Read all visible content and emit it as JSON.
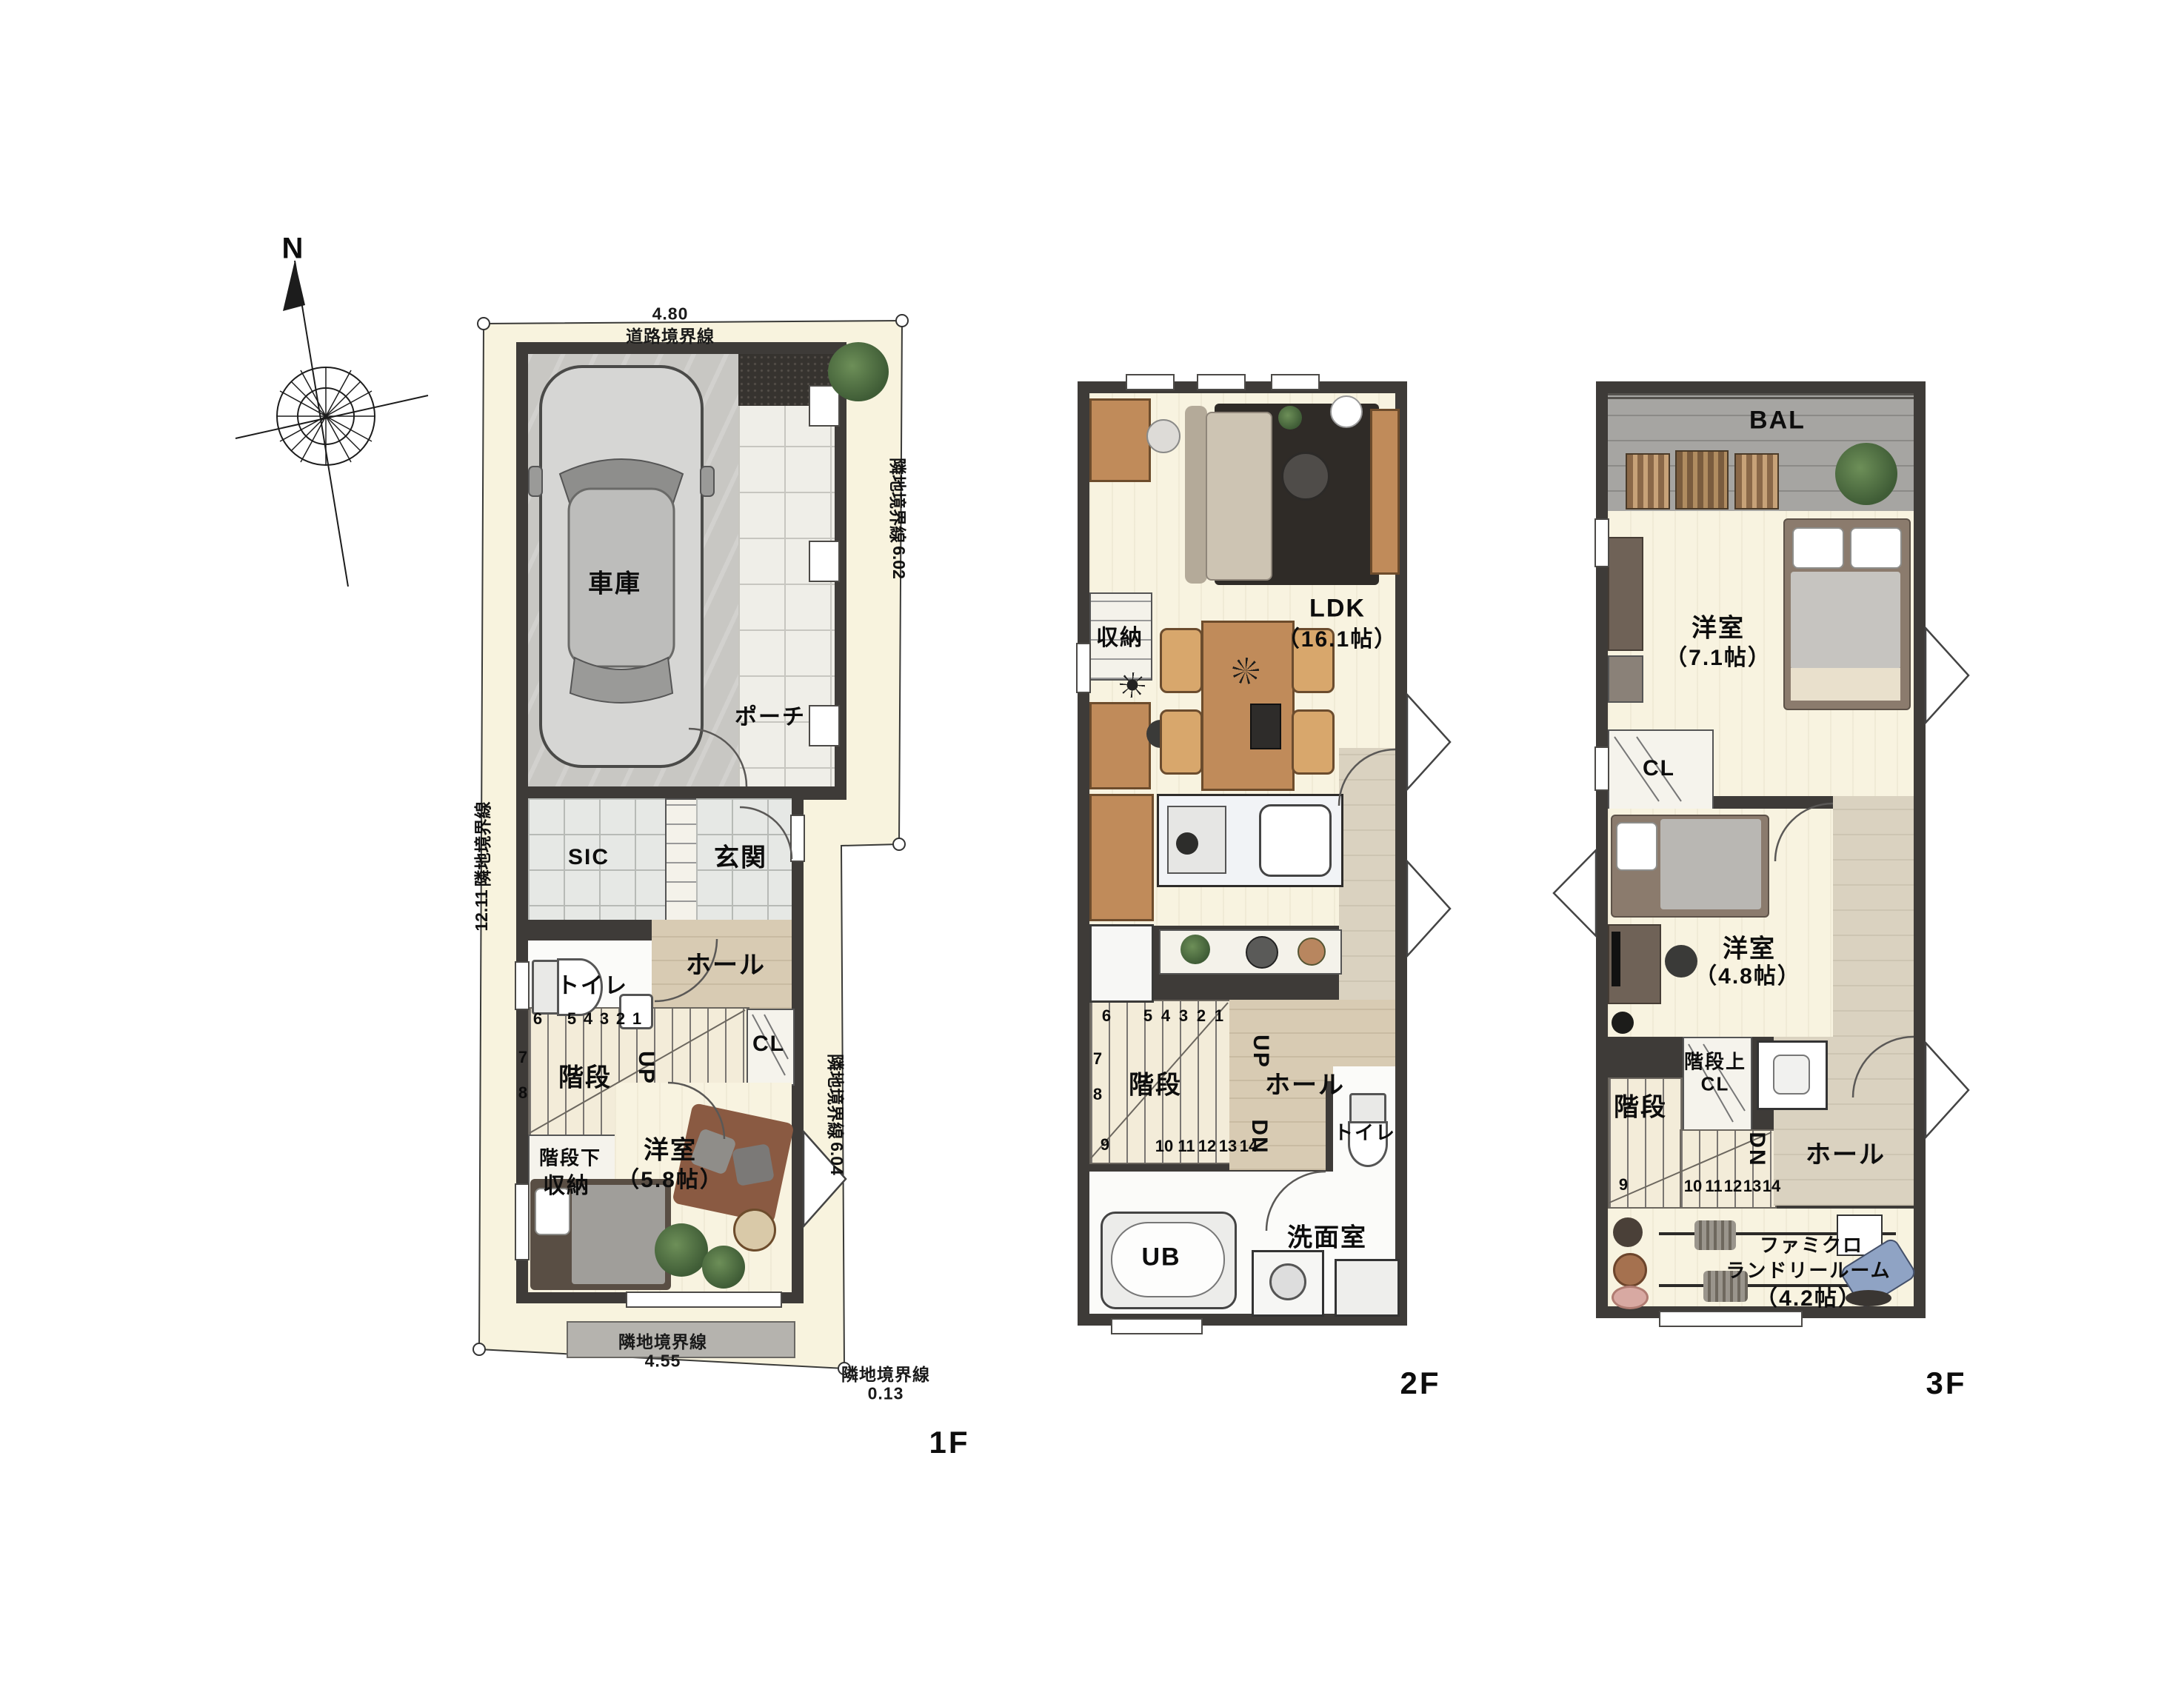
{
  "compass": {
    "north": "N"
  },
  "site": {
    "road_line": "道路境界線",
    "road_dim": "4.80",
    "left_line": "隣地境界線",
    "left_dim": "12.11",
    "right_upper_line": "隣地境界線",
    "right_upper_dim": "6.02",
    "right_lower_line": "隣地境界線",
    "right_lower_dim": "6.04",
    "bottom_line": "隣地境界線",
    "bottom_dim": "4.55",
    "bottom_right_line": "隣地境界線",
    "bottom_right_dim": "0.13"
  },
  "f1": {
    "floor": "1F",
    "garage": "車庫",
    "porch": "ポーチ",
    "sic": "SIC",
    "entrance": "玄関",
    "toilet": "トイレ",
    "hall": "ホール",
    "stairs": "階段",
    "cl": "CL",
    "understair1": "階段下",
    "understair2": "収納",
    "bedroom": "洋室",
    "bedroom_size": "（5.8帖）",
    "up": "UP",
    "steps": [
      "6",
      "5",
      "4",
      "3",
      "2",
      "1"
    ],
    "step7": "7",
    "step8": "8"
  },
  "f2": {
    "floor": "2F",
    "storage": "収納",
    "ldk": "LDK",
    "ldk_size": "（16.1帖）",
    "stairs": "階段",
    "hall": "ホール",
    "toilet": "トイレ",
    "bath": "UB",
    "wash": "洗面室",
    "up": "UP",
    "dn": "DN",
    "steps": [
      "6",
      "5",
      "4",
      "3",
      "2",
      "1"
    ],
    "step7": "7",
    "step8": "8",
    "step9": "9",
    "steps2": [
      "10",
      "11",
      "12",
      "13",
      "14"
    ]
  },
  "f3": {
    "floor": "3F",
    "bal": "BAL",
    "bedroom1": "洋室",
    "bedroom1_size": "（7.1帖）",
    "cl": "CL",
    "bedroom2": "洋室",
    "bedroom2_size": "（4.8帖）",
    "stair_cl1": "階段上",
    "stair_cl2": "CL",
    "stairs": "階段",
    "hall": "ホール",
    "famiclo1": "ファミクロ",
    "famiclo2": "ランドリールーム",
    "famiclo3": "（4.2帖）",
    "dn": "DN",
    "step9": "9",
    "steps2": [
      "10",
      "11",
      "12",
      "13",
      "14"
    ]
  },
  "colors": {
    "wall": "#3e3b38",
    "site_fill": "#f8f3de",
    "room_floor": "#f8f3e0",
    "wood_floor": "#d8cbb3",
    "tile": "#e6e8e5",
    "concrete": "#c8c7c3",
    "deck": "#a6a5a2",
    "rug_dark": "#2f2b27",
    "rug_brown": "#8a5a42",
    "furniture_wood": "#c08b5a",
    "plant_green": "#4e7046",
    "text": "#0d0d0d"
  }
}
